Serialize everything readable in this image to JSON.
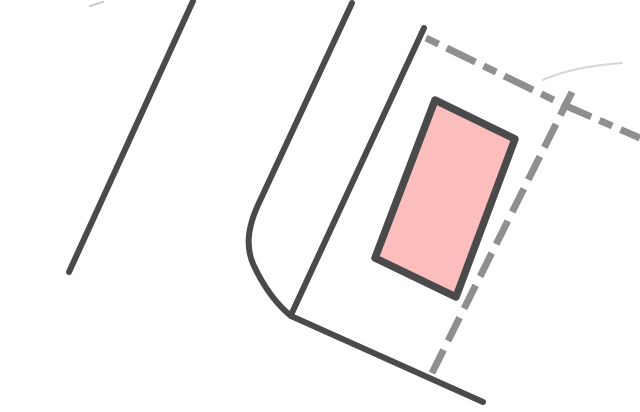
{
  "canvas": {
    "width": "640",
    "height": "412",
    "viewbox": "0 0 640 412",
    "background": "#ffffff"
  },
  "palette": {
    "road_line": "#4a4a4a",
    "boundary_dash": "#8f8f8f",
    "building_fill": "#fcbdbd",
    "building_border": "#4a4a4a",
    "faint_mark": "#c9c9c9",
    "faint_scratch": "#d6d6d6"
  },
  "features": {
    "road_edge_left": {
      "name": "road edge line (left, solid)",
      "d": "M 193 1 L 69 272"
    },
    "road_edge_curved": {
      "name": "road edge line with corner fillet curving into bottom diagonal",
      "d": "M 352 3 L 258 205 C 248 227 245 247 254 266 C 263 285 275 303 291 316 L 483 402"
    },
    "road_edge_inner": {
      "name": "inner road edge line ending at curve junction",
      "d": "M 424 28 L 291 315"
    },
    "boundary_top": {
      "name": "dashed parcel boundary (upper), bends at tee junction",
      "d": "M 426 38 L 564 105 L 640 138"
    },
    "boundary_right": {
      "name": "dashed parcel boundary (right side), crosses tee and runs to road line",
      "d": "M 572 92 L 429 379"
    },
    "building_footprint": {
      "name": "pink building footprint (rotated rectangle)",
      "points": "435,100 515,139 456,297 375,258"
    },
    "artifact_tick_topleft": {
      "name": "faint small scan mark, top left",
      "d": "M 90 6 L 103 2"
    },
    "artifact_scratch_right": {
      "name": "faint thin scratch above tee junction",
      "d": "M 543 80 C 562 71 592 65 622 63"
    }
  }
}
